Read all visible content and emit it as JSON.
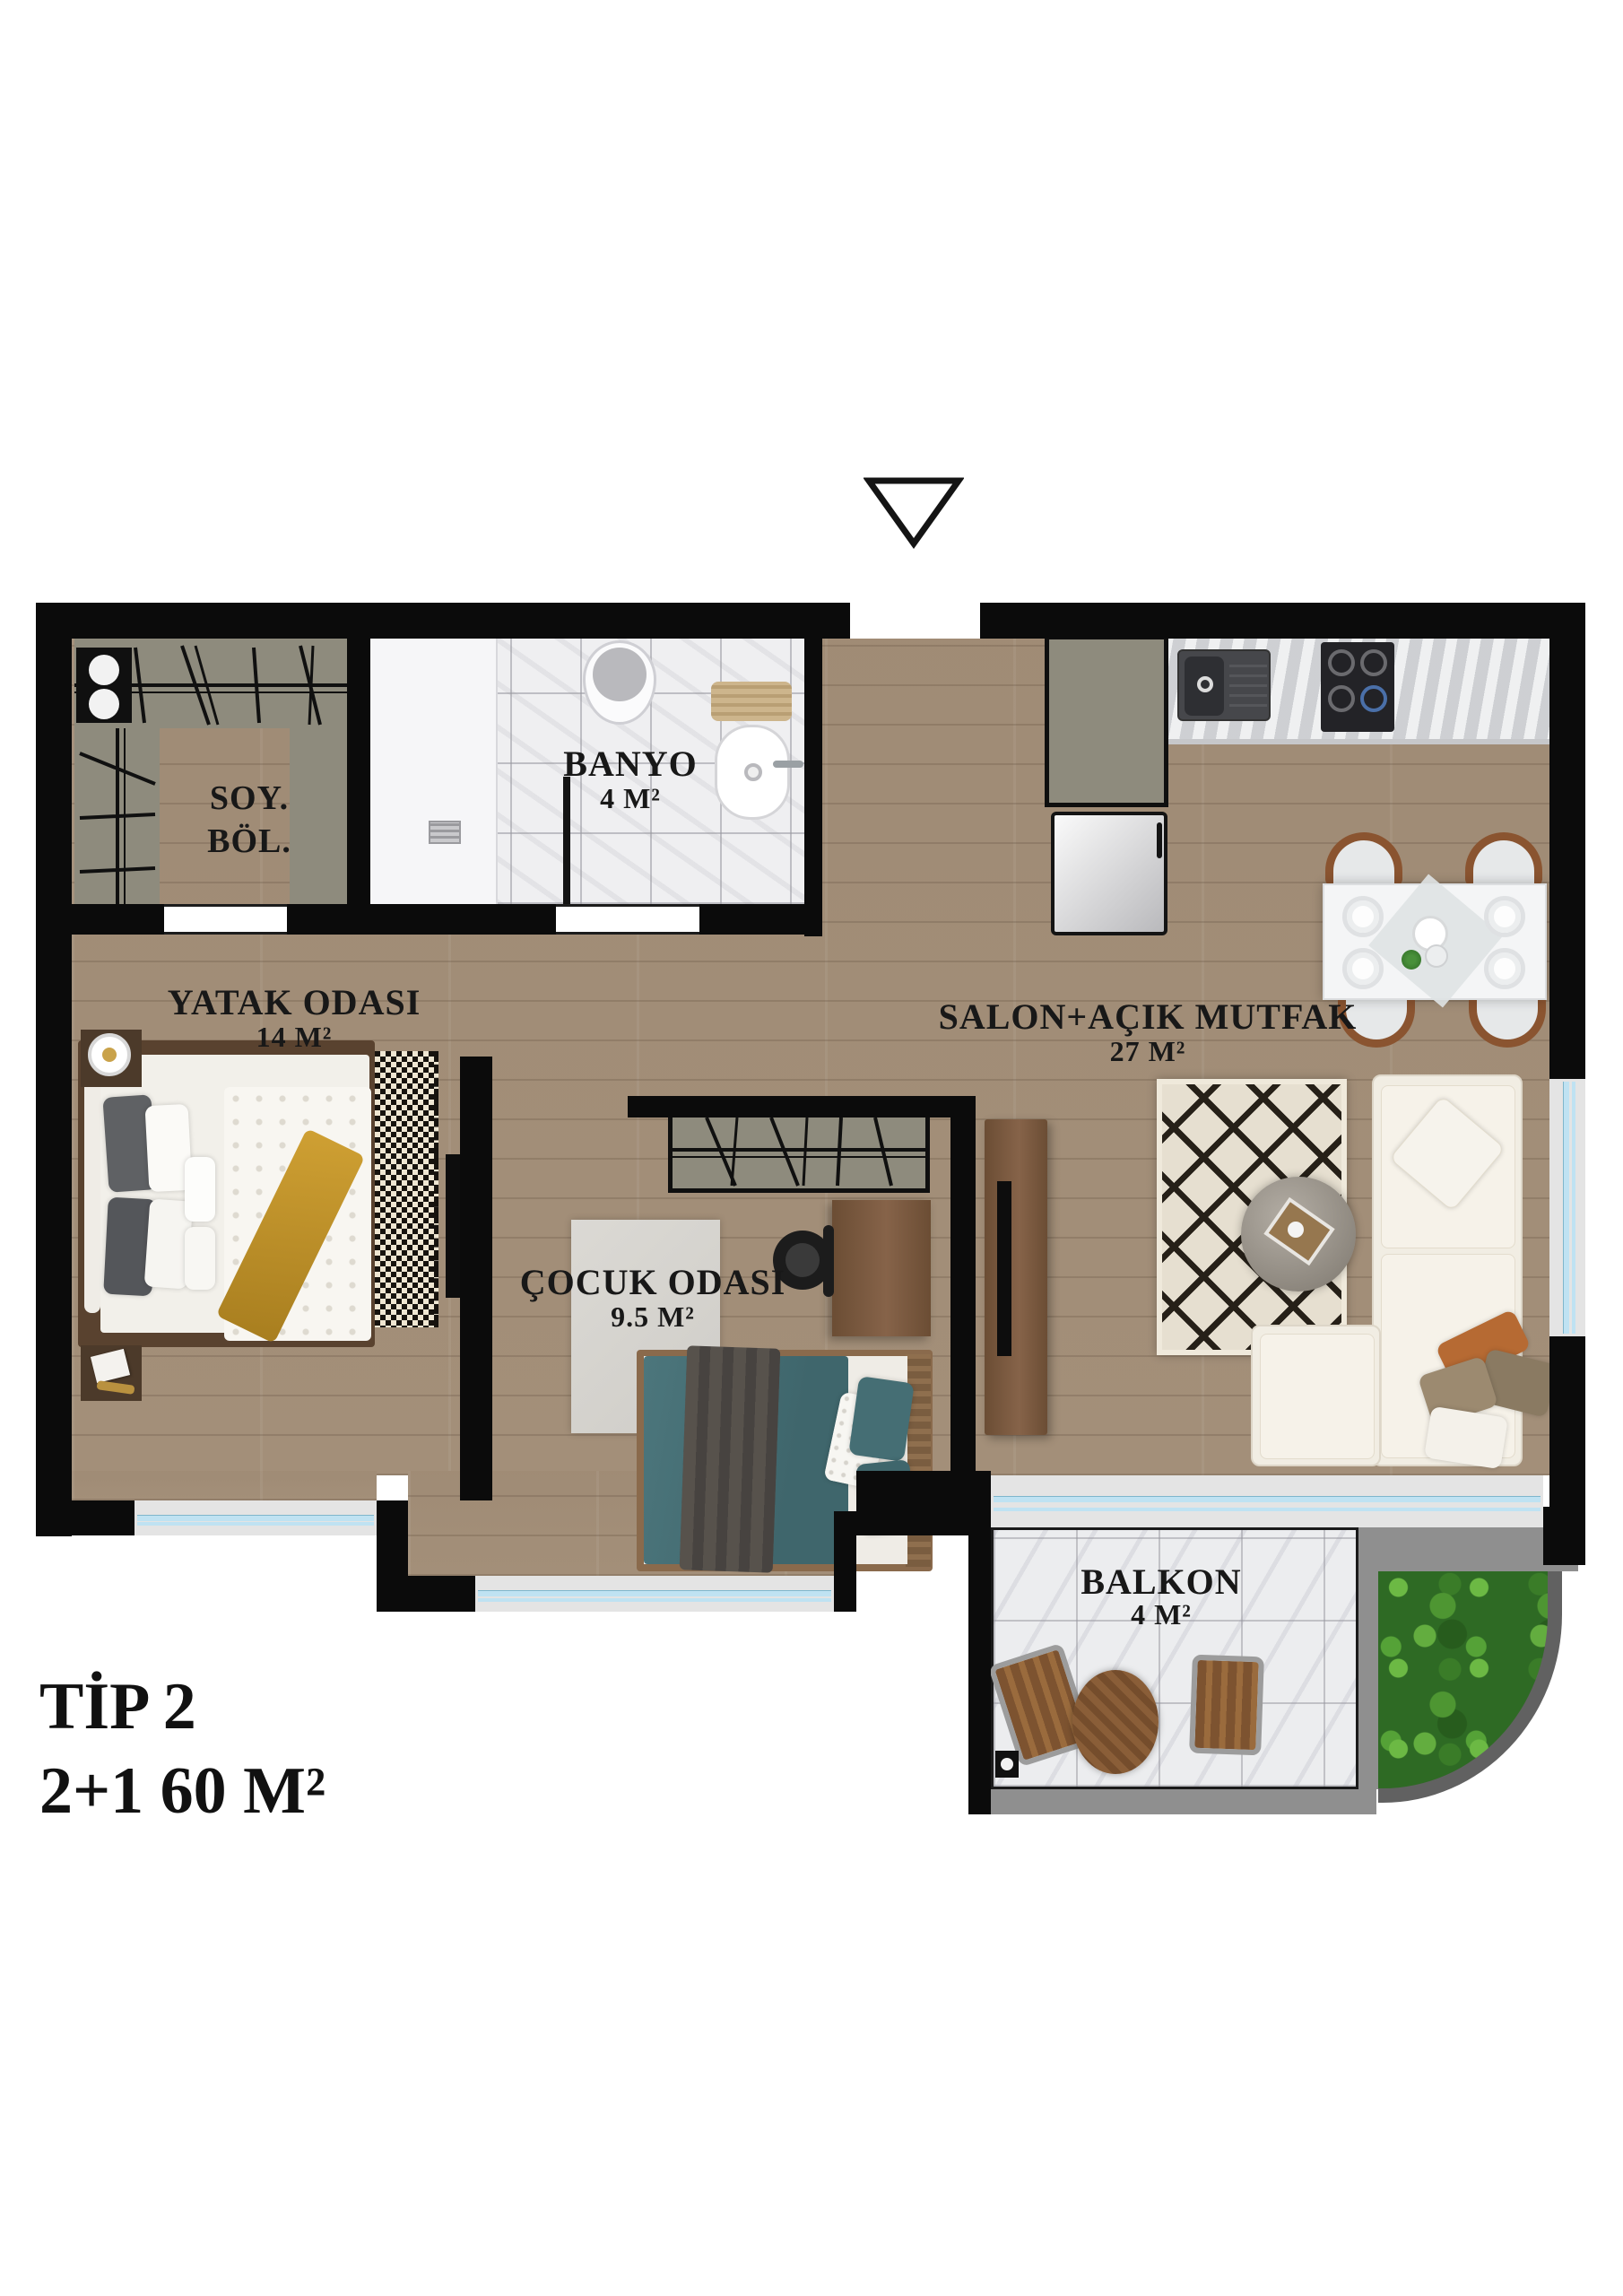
{
  "plan": {
    "type_label": "TİP 2",
    "spec_label": "2+1 60 M²"
  },
  "rooms": {
    "dressing": {
      "abbr1": "SOY.",
      "abbr2": "BÖL."
    },
    "bathroom": {
      "name": "BANYO",
      "area": "4 M²"
    },
    "bedroom": {
      "name": "YATAK ODASI",
      "area": "14 M²"
    },
    "living_kitchen": {
      "name": "SALON+AÇIK MUTFAK",
      "area": "27 M²"
    },
    "kids_room": {
      "name": "ÇOCUK ODASI",
      "area": "9.5 M²"
    },
    "balcony": {
      "name": "BALKON",
      "area": "4 M²"
    }
  },
  "icons": {
    "entrance_marker": "downward-triangle-entrance-marker"
  },
  "colors": {
    "wall": "#0b0b0b",
    "wood": "#a4907a",
    "marble": "#efeff1",
    "closet": "#8e8b7d",
    "glass": "#bfe2f2",
    "teal": "#4c767c",
    "mustard": "#cfa033",
    "garden": "#2e6a24",
    "sofa": "#f1ede3",
    "rug-cream": "#e6dfd0",
    "rug-ink": "#262018",
    "furn-wood": "#7a5b41",
    "rail": "#8f8f8f"
  }
}
